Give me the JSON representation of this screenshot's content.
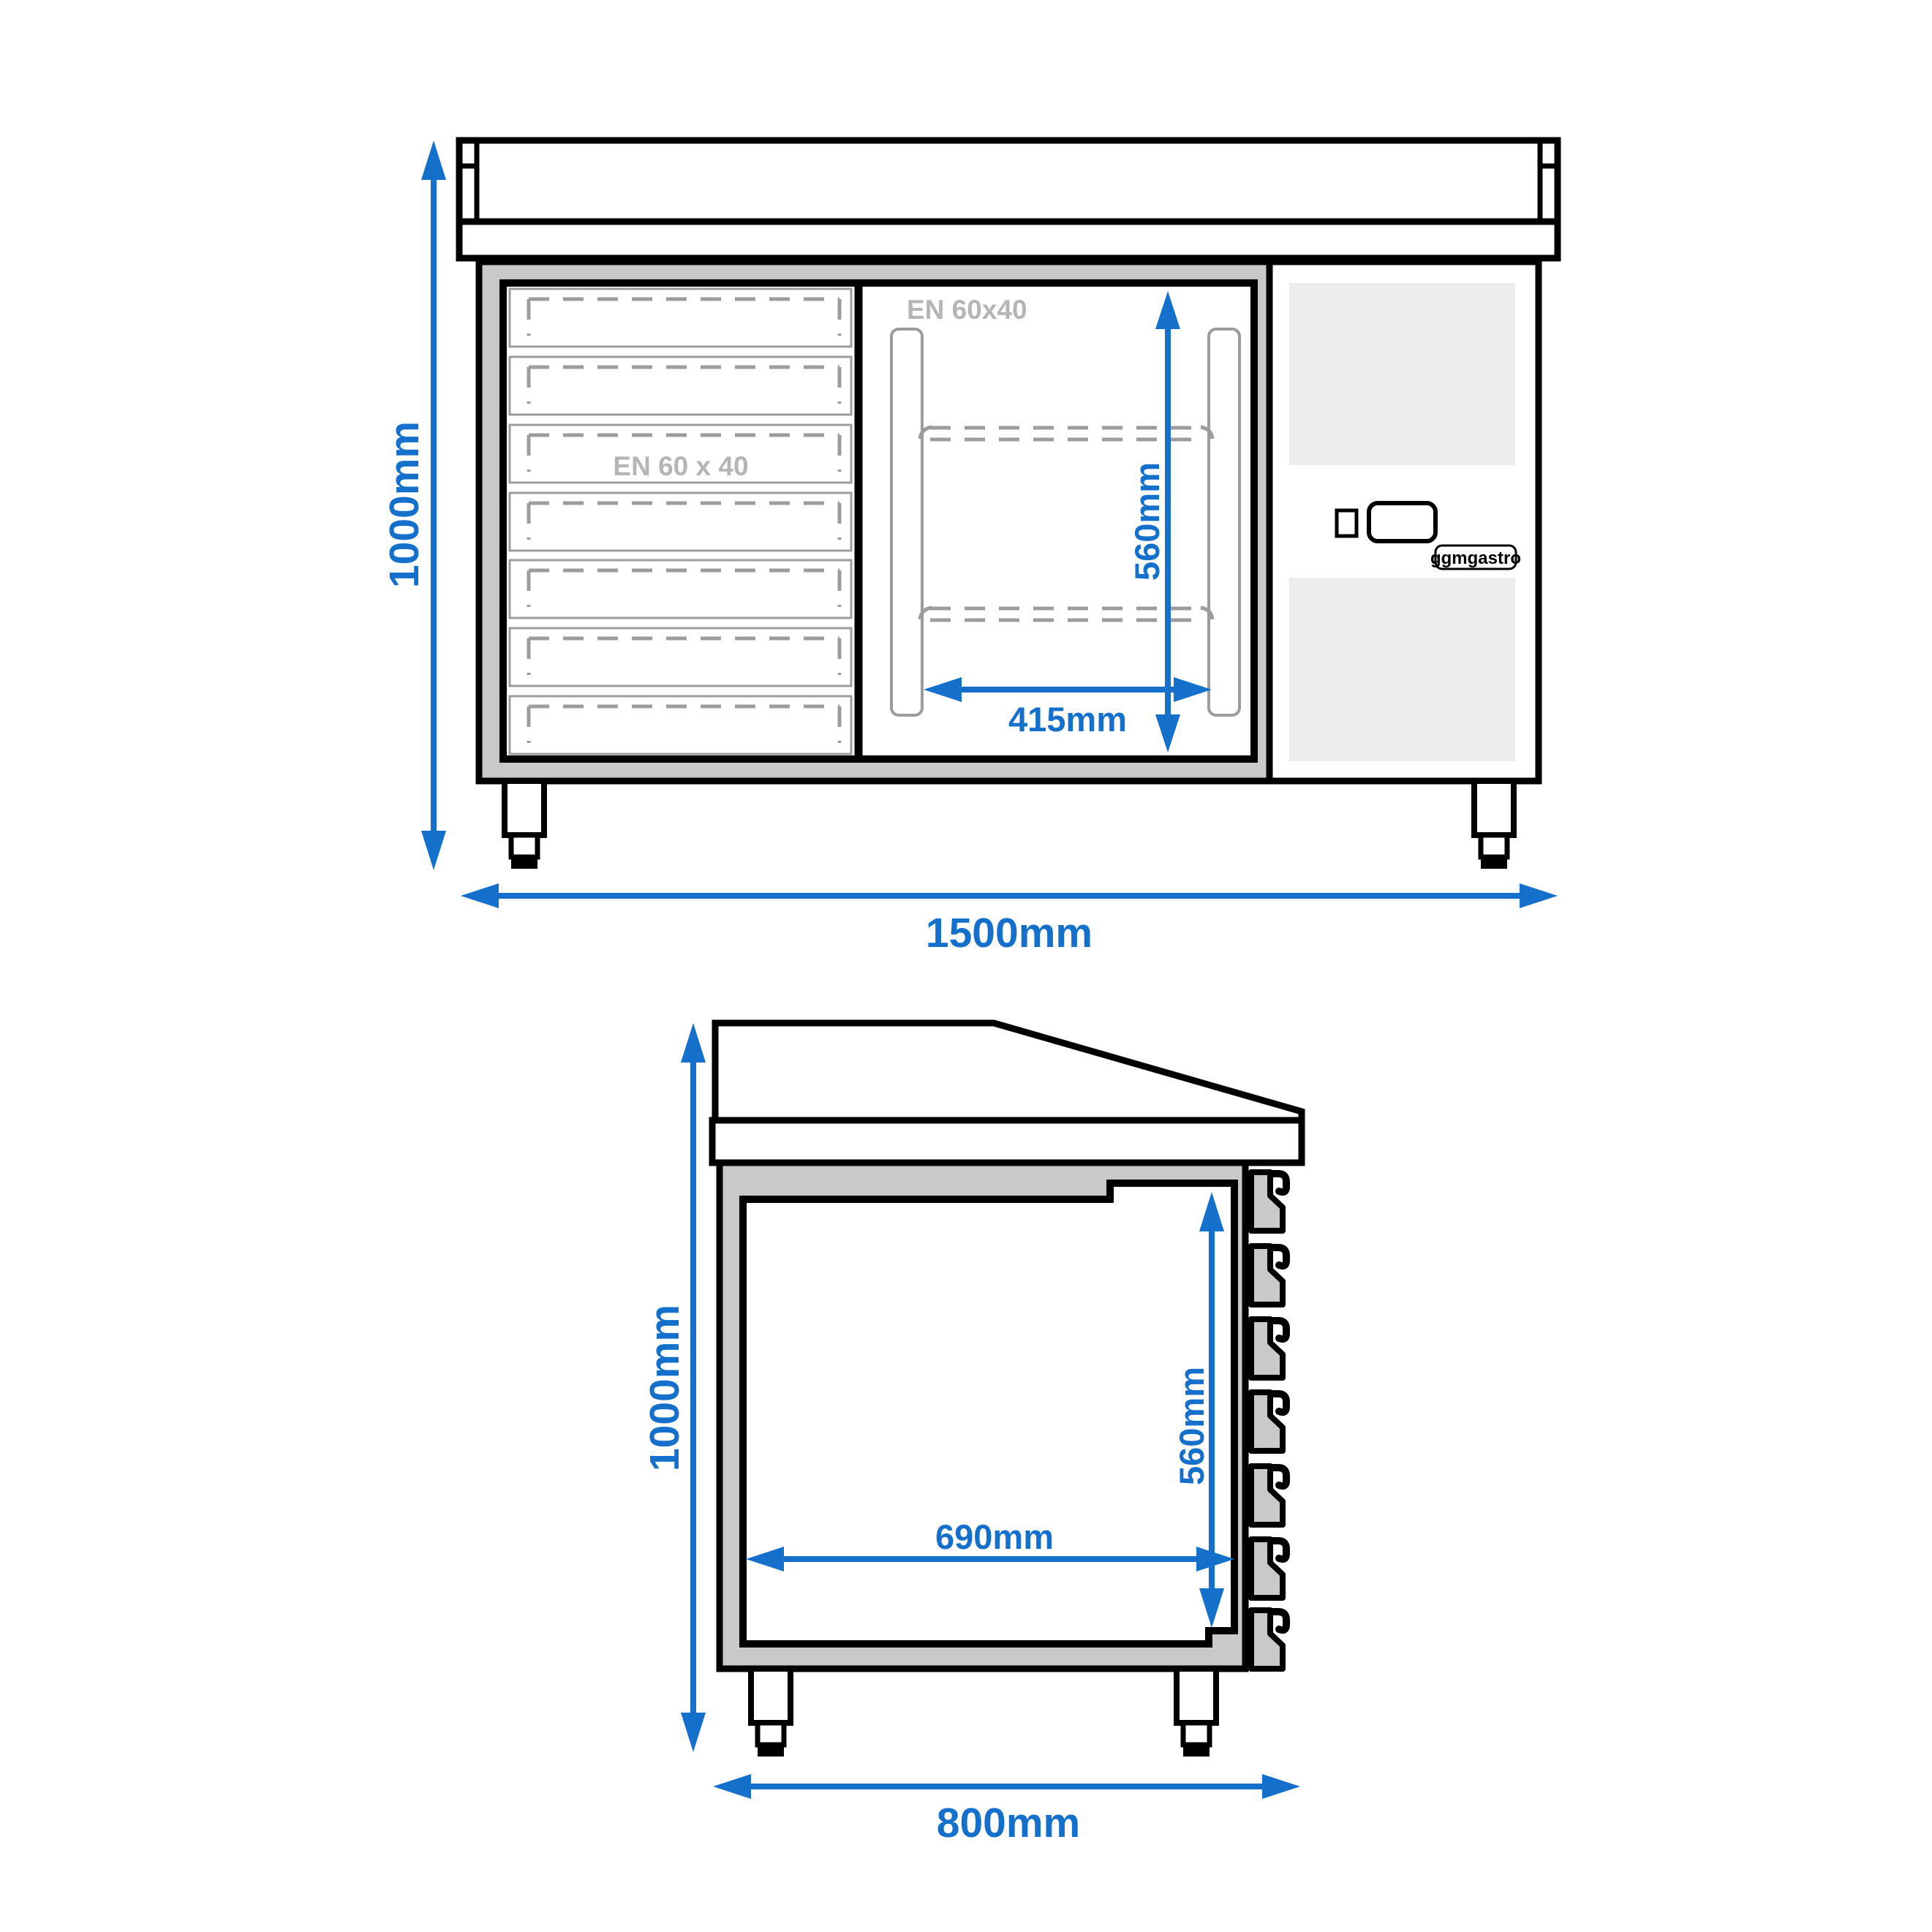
{
  "colors": {
    "dimension_blue": "#1470cb",
    "outline_black": "#000000",
    "body_gray": "#c9c9c9",
    "vent_gray": "#ededed",
    "detail_gray": "#9c9c9c",
    "label_gray": "#b5b5b5"
  },
  "front_view": {
    "overall_height": "1000mm",
    "overall_width": "1500mm",
    "door_inner_height": "560mm",
    "door_inner_width": "415mm",
    "drawer_tray_label": "EN 60 x 40",
    "door_tray_label": "EN 60x40",
    "brand": "ggmgastro",
    "drawer_count": 7,
    "shelf_count": 2,
    "leg_count": 2
  },
  "side_view": {
    "overall_height": "1000mm",
    "overall_depth": "800mm",
    "inner_depth": "690mm",
    "inner_height": "560mm",
    "rail_count": 7,
    "leg_count": 2
  }
}
